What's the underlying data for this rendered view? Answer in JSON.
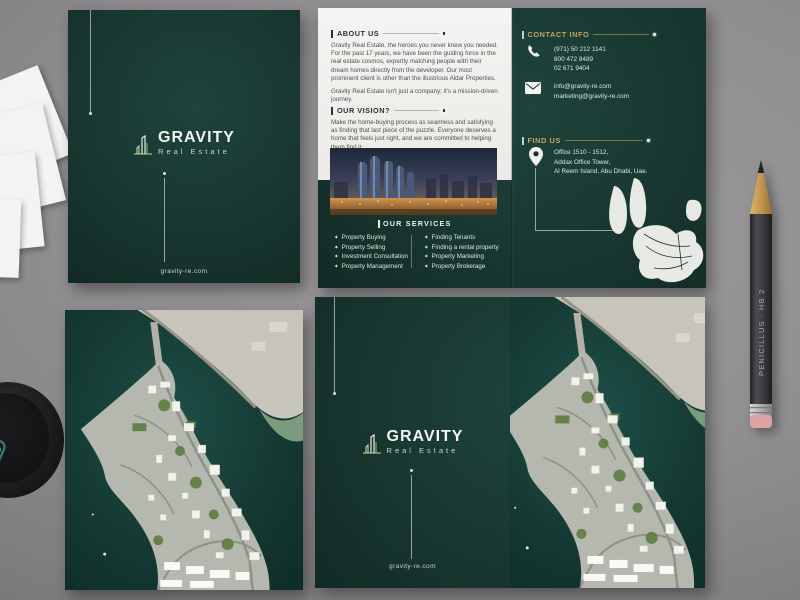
{
  "brand": {
    "name": "GRAVITY",
    "tagline": "Real Estate",
    "website": "gravity-re.com"
  },
  "inside": {
    "about": {
      "heading": "ABOUT US",
      "para1": "Gravity Real Estate, the heroes you never knew you needed. For the past 17 years, we have been the guiding force in the real estate cosmos, expertly matching people with their dream homes directly from the developer. Our most prominent client is other than the illustrious Aldar Properties.",
      "para2": "Gravity Real Estate isn't just a company; it's a mission-driven journey."
    },
    "vision": {
      "heading": "OUR VISION?",
      "para": "Make the home-buying process as seamless and satisfying as finding that last piece of the puzzle. Everyone deserves a home that feels just right, and we are committed to helping them find it."
    },
    "services": {
      "heading": "OUR SERVICES",
      "bullet": "✦",
      "left": [
        "Property Buying",
        "Property Selling",
        "Investment Consultation",
        "Property Management"
      ],
      "right": [
        "Finding Tenants",
        "Finding a rental property",
        "Property Marketing",
        "Property Brokerage"
      ]
    },
    "contact": {
      "heading": "CONTACT INFO",
      "phones": [
        "(971) 50 212 1141",
        "800 472 8489",
        "02 671 9404"
      ],
      "emails": [
        "info@gravity-re.com",
        "marketing@gravity-re.com"
      ]
    },
    "find_us": {
      "heading": "FIND US",
      "address": [
        "Office 1510 - 1512,",
        "Addax Office Tower,",
        "Al Reem Island, Abu Dhabi, Uae."
      ]
    }
  },
  "pencil": {
    "text": "PENICILLUS · HB 2"
  },
  "icons": {
    "phone": "phone-receiver",
    "email": "envelope",
    "location": "map-pin",
    "logo": "skyline-towers"
  },
  "colors": {
    "brand_green": "#17352E",
    "accent_gold": "#C3A468",
    "panel_white": "#F2F1EF"
  }
}
